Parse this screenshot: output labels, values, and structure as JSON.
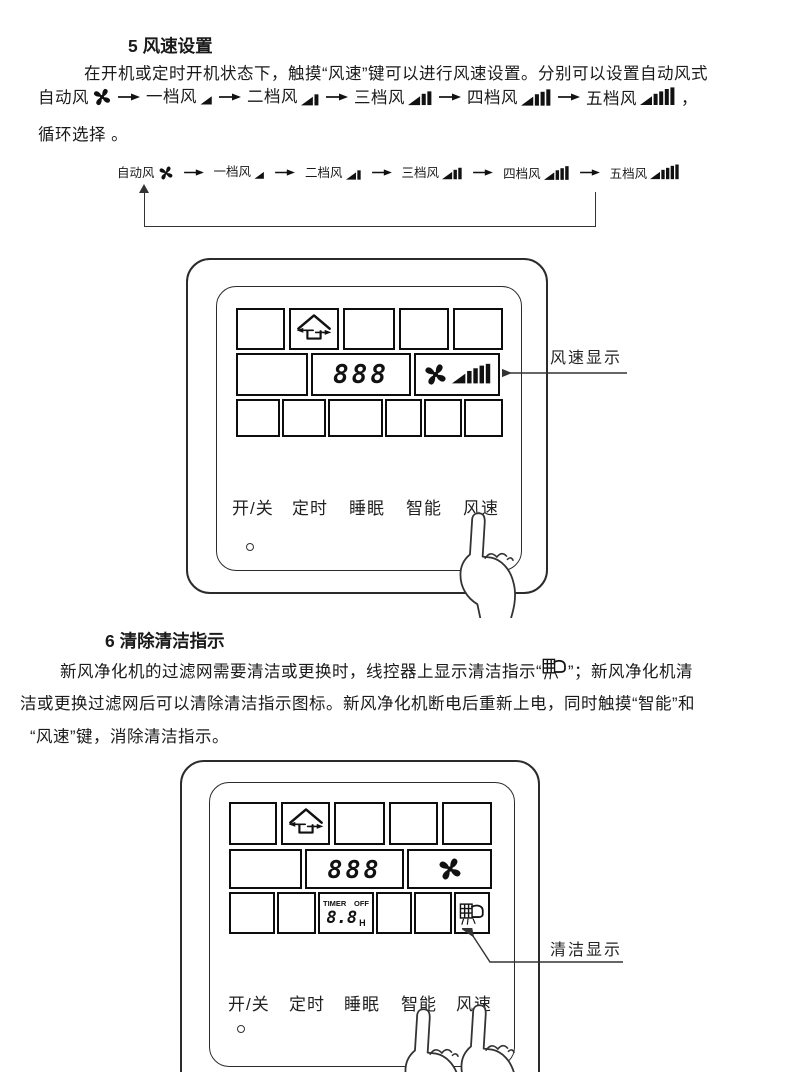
{
  "page": {
    "background": "#ffffff",
    "ink": "#1a1a1a"
  },
  "section5": {
    "title": "5 风速设置",
    "line1": "在开机或定时开机状态下，触摸“风速”键可以进行风速设置。分别可以设置自动风式",
    "flow_comma": "，",
    "line3": "循环选择 。"
  },
  "flow": {
    "items": [
      {
        "label": "自动风",
        "icon": "fan-icon"
      },
      {
        "label": "一档风",
        "icon": "speed-ramp-1-icon"
      },
      {
        "label": "二档风",
        "icon": "speed-ramp-2-icon"
      },
      {
        "label": "三档风",
        "icon": "speed-ramp-3-icon"
      },
      {
        "label": "四档风",
        "icon": "speed-ramp-4-icon"
      },
      {
        "label": "五档风",
        "icon": "speed-ramp-5-icon"
      }
    ],
    "loop": "cycle-back-to-auto"
  },
  "panel": {
    "display_value": "888",
    "timer_label": "TIMER",
    "timer_off": "OFF",
    "timer_value": "8.8",
    "timer_unit": "H",
    "buttons": [
      "开/关",
      "定时",
      "睡眠",
      "智能",
      "风速"
    ],
    "icons": [
      "home-ventilation-icon",
      "fan-icon",
      "speed-ramp-5-icon",
      "clean-filter-icon"
    ]
  },
  "panel1": {
    "callout": "风速显示"
  },
  "panel2": {
    "callout": "清洁显示"
  },
  "section6": {
    "title": "6 清除清洁指示",
    "line1_pre": "新风净化机的过滤网需要清洁或更换时，线控器上显示清洁指示“",
    "line1_post": "”；新风净化机清",
    "line2": "洁或更换过滤网后可以清除清洁指示图标。新风净化机断电后重新上电，同时触摸“智能”和",
    "line3": "“风速”键，消除清洁指示。"
  }
}
